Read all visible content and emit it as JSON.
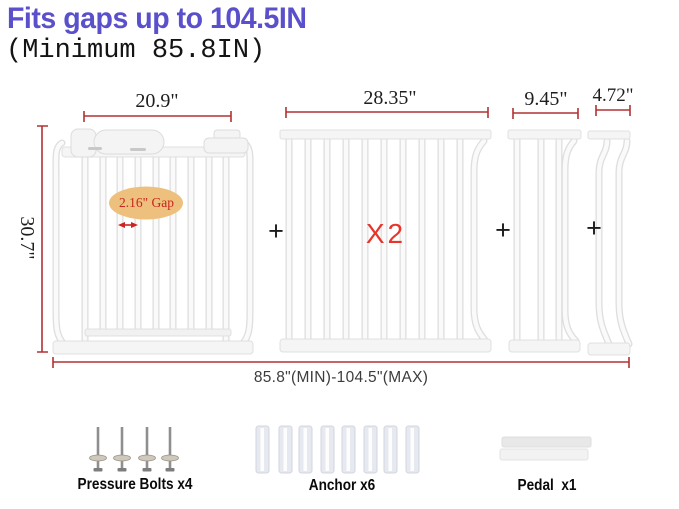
{
  "header": {
    "title": "Fits gaps up to 104.5IN",
    "subtitle": "(Minimum 85.8IN)"
  },
  "colors": {
    "title_blue": "#5a50cb",
    "dimension_red": "#b23232",
    "accent_red": "#e8352b",
    "gap_ellipse_fill": "#eec07d",
    "gate_white": "#fafafa",
    "gate_edge": "#dedede"
  },
  "diagram": {
    "panels": [
      {
        "name": "main-gate",
        "width_label": "20.9\"",
        "height_label": "30.7\"",
        "gap_label": "2.16\" Gap"
      },
      {
        "name": "extension-wide",
        "width_label": "28.35\"",
        "quantity_label": "X2"
      },
      {
        "name": "extension-medium",
        "width_label": "9.45\""
      },
      {
        "name": "extension-small",
        "width_label": "4.72\""
      }
    ],
    "plus_sign": "+",
    "total_range_label": "85.8\"(MIN)-104.5\"(MAX)"
  },
  "parts": [
    {
      "label": "Pressure Bolts x4"
    },
    {
      "label": "Anchor x6"
    },
    {
      "label": "Pedal  x1"
    }
  ]
}
